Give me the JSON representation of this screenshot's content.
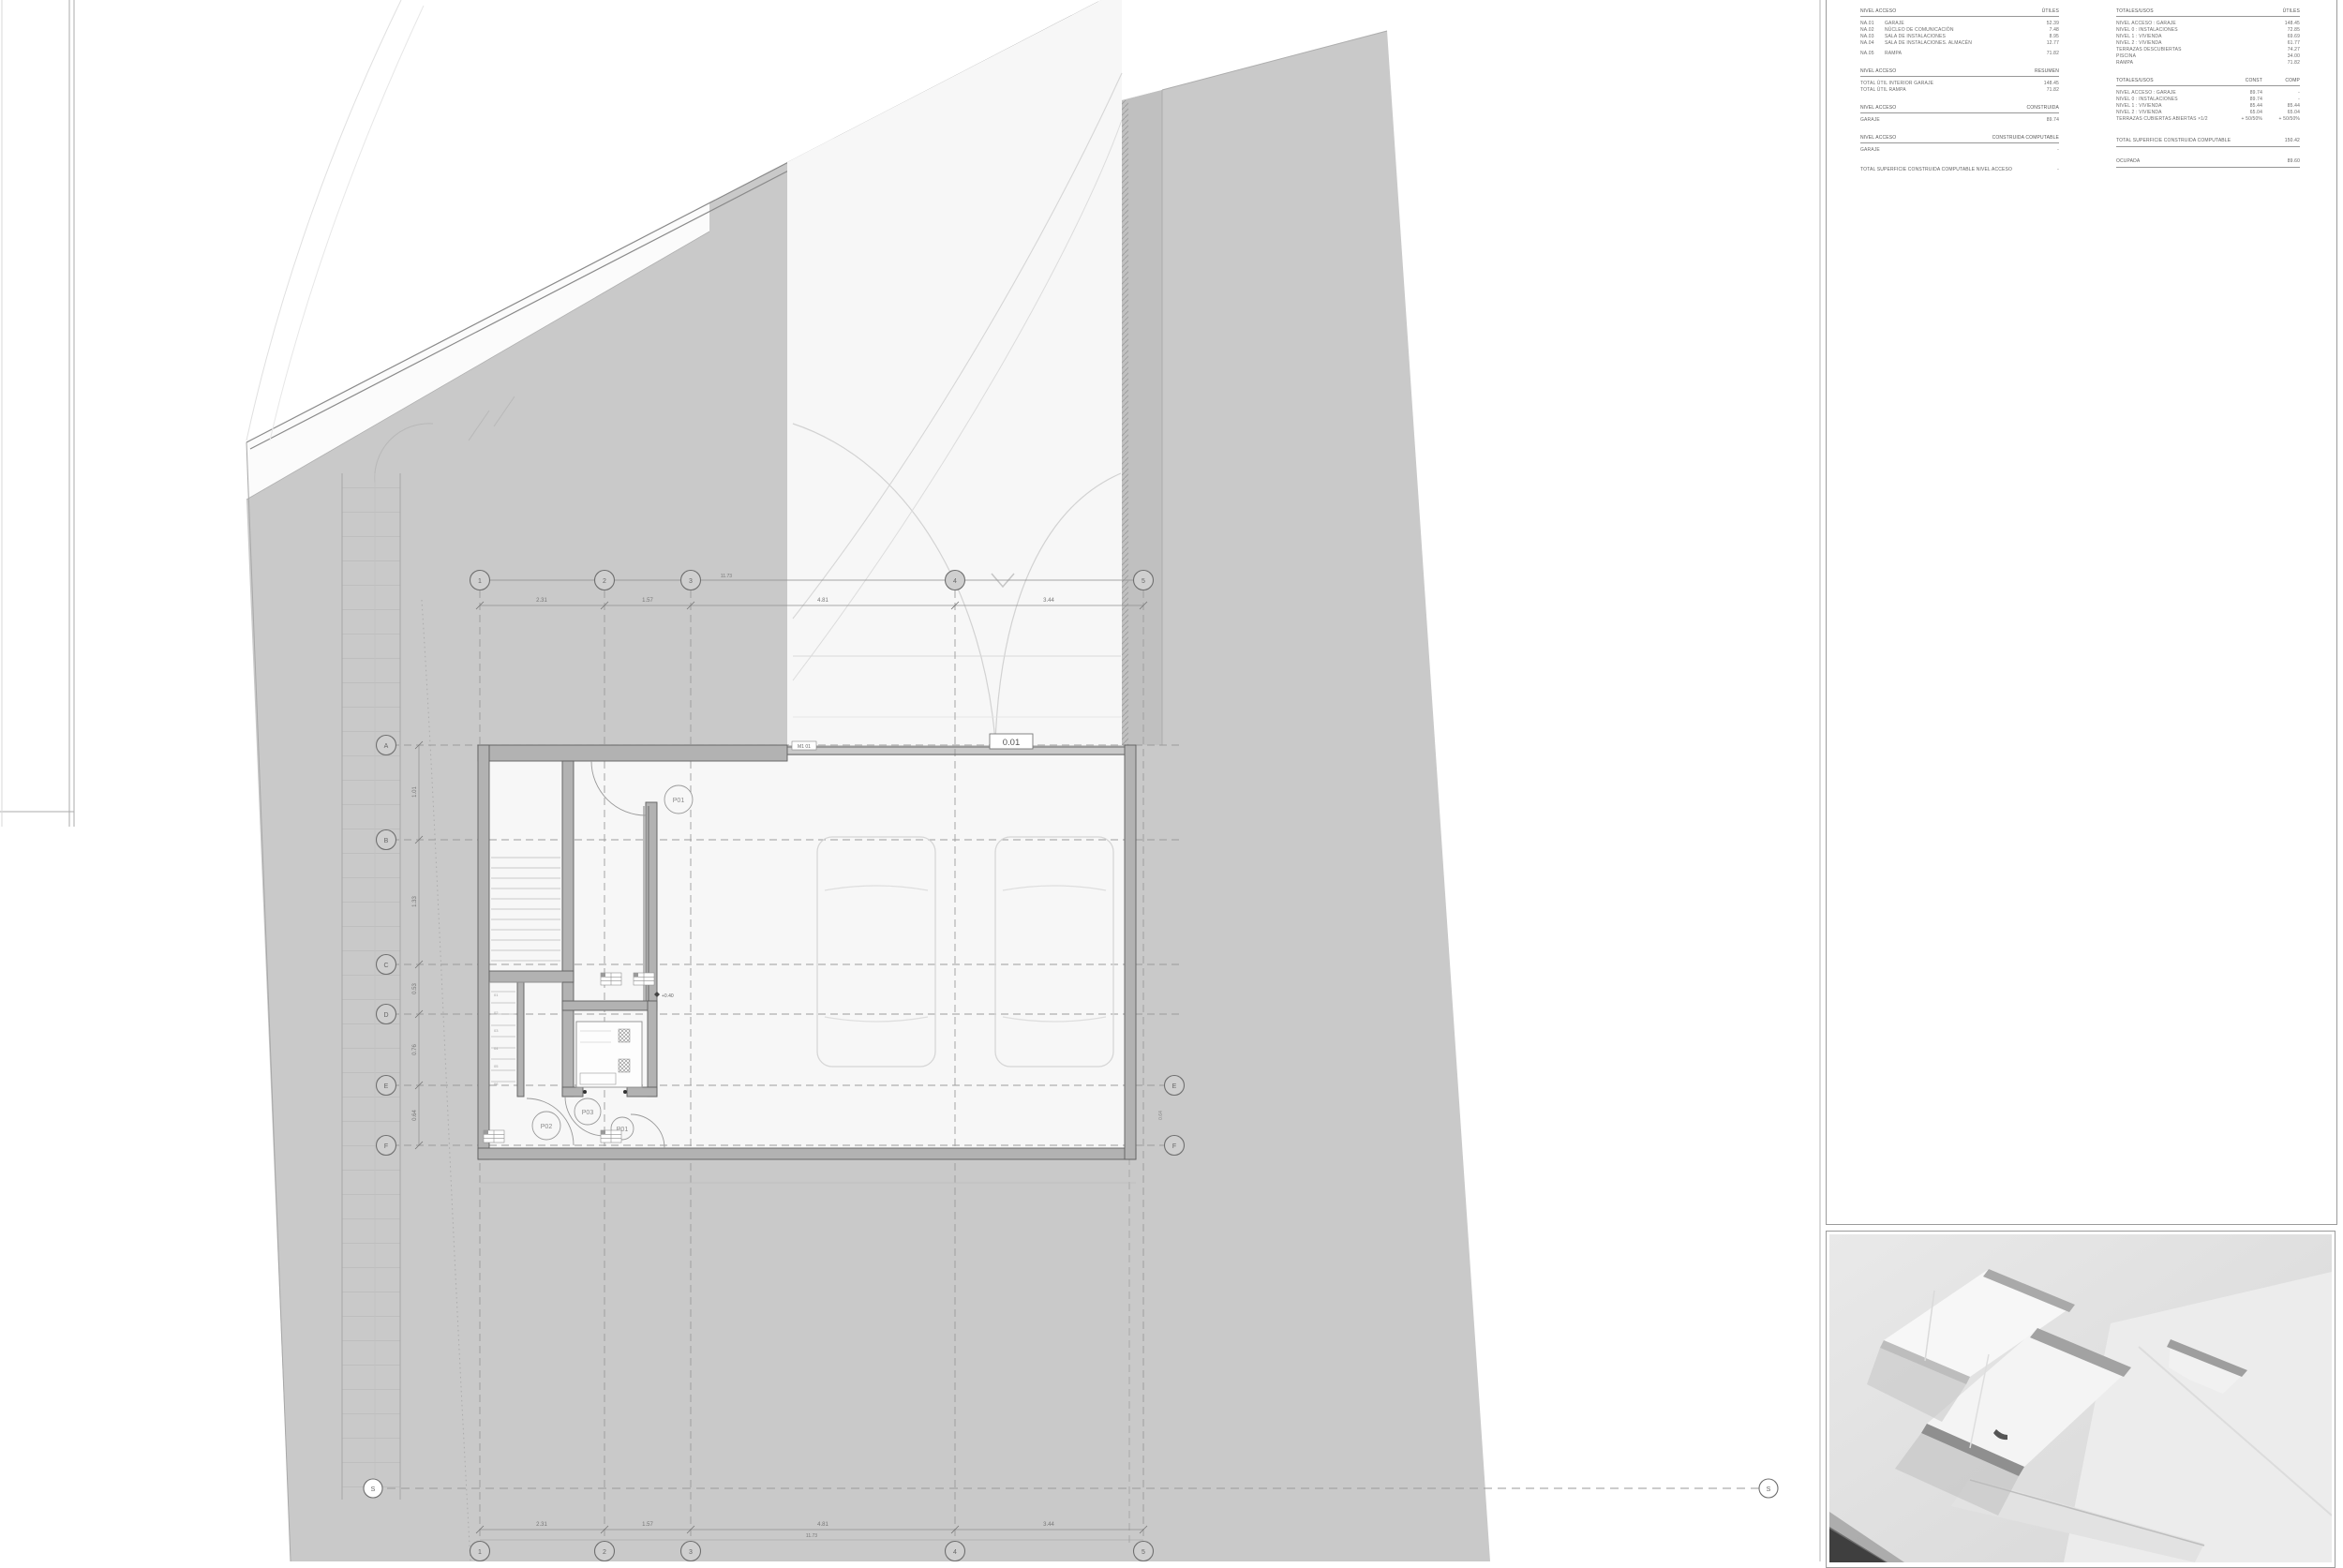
{
  "tables": {
    "access": {
      "s1": {
        "title": "NIVEL ACCESO",
        "col": "ÚTILES",
        "rows": [
          {
            "c": "NA.01",
            "d": "GARAJE",
            "v": "52.39"
          },
          {
            "c": "NA.02",
            "d": "NÚCLEO DE COMUNICACIÓN",
            "v": "7.48"
          },
          {
            "c": "NA.03",
            "d": "SALA DE INSTALACIONES",
            "v": "8.95"
          },
          {
            "c": "NA.04",
            "d": "SALA DE INSTALACIONES. ALMACÉN",
            "v": "12.77"
          },
          {
            "c": "NA.05",
            "d": "RAMPA",
            "v": "71.82"
          }
        ]
      },
      "s2": {
        "title": "NIVEL ACCESO",
        "col": "RESUMEN",
        "rows": [
          {
            "d": "TOTAL ÚTIL INTERIOR GARAJE",
            "v": "148.45"
          },
          {
            "d": "TOTAL ÚTIL RAMPA",
            "v": "71.82"
          }
        ]
      },
      "s3": {
        "title": "NIVEL ACCESO",
        "col": "CONSTRUIDA",
        "rows": [
          {
            "d": "GARAJE",
            "v": "89.74"
          }
        ]
      },
      "s4": {
        "title": "NIVEL ACCESO",
        "col": "CONSTRUIDA COMPUTABLE",
        "rows": [
          {
            "d": "GARAJE",
            "v": "-"
          }
        ]
      },
      "footer": {
        "d": "TOTAL SUPERFICIE CONSTRUIDA COMPUTABLE NIVEL ACCESO",
        "v": "-"
      }
    },
    "totals": {
      "s1": {
        "title": "TOTALES/USOS",
        "col": "ÚTILES",
        "rows": [
          {
            "d": "NIVEL ACCESO : GARAJE",
            "v": "148.45"
          },
          {
            "d": "NIVEL 0 : INSTALACIONES",
            "v": "72.85"
          },
          {
            "d": "NIVEL 1 : VIVIENDA",
            "v": "69.69"
          },
          {
            "d": "NIVEL 2 : VIVIENDA",
            "v": "61.77"
          },
          {
            "d": "TERRAZAS DESCUBIERTAS",
            "v": "74.27"
          },
          {
            "d": "PISCINA",
            "v": "34.00"
          },
          {
            "d": "RAMPA",
            "v": "71.82"
          }
        ]
      },
      "s2": {
        "title": "TOTALES/USOS",
        "col1": "CONST",
        "col2": "COMP",
        "rows": [
          {
            "d": "NIVEL ACCESO : GARAJE",
            "a": "89.74",
            "b": "-"
          },
          {
            "d": "NIVEL 0 : INSTALACIONES",
            "a": "89.74",
            "b": "-"
          },
          {
            "d": "NIVEL 1 : VIVIENDA",
            "a": "85.44",
            "b": "85.44"
          },
          {
            "d": "NIVEL 2 : VIVIENDA",
            "a": "65.04",
            "b": "65.04"
          },
          {
            "d": "TERRAZAS CUBIERTAS ABIERTAS ×1/2",
            "a": "+ 50/50%",
            "b": "+ 50/50%"
          }
        ]
      },
      "total": {
        "d": "TOTAL SUPERFICIE CONSTRUIDA COMPUTABLE",
        "v": "150.42"
      },
      "ocupada": {
        "d": "OCUPADA",
        "v": "89.60"
      }
    }
  },
  "plan": {
    "room_tag": "0.01",
    "threshold_tag": "M1 01",
    "level_marker": "+0.40",
    "grid_cols": [
      "1",
      "2",
      "3",
      "4",
      "5"
    ],
    "grid_rows": [
      "A",
      "B",
      "C",
      "D",
      "E",
      "F"
    ],
    "grid_rows_right": [
      "E",
      "F"
    ],
    "section_marks": [
      "S",
      "S"
    ],
    "door_tags": {
      "p01_top": "P01",
      "p02": "P02",
      "p03": "P03",
      "p01_bottom": "P01"
    },
    "dims_top": [
      "2.31",
      "1.57",
      "4.81",
      "3.44"
    ],
    "dims_bottom": [
      "2.31",
      "1.57",
      "4.81",
      "3.44"
    ],
    "overall_dim": "11.73",
    "dims_left": [
      "1.01",
      "1.33",
      "0.53",
      "0.76",
      "0.64"
    ],
    "dim_right": "0.64",
    "stair_steps": [
      "01",
      "02",
      "03",
      "04",
      "05",
      "06"
    ]
  },
  "colors": {
    "site": "#c9c9c9",
    "interior": "#f7f7f7",
    "wall": "#b2b2b2",
    "wall_line": "#5f5f5f",
    "dash": "#9c9c9c",
    "band": "#c0c0c0",
    "photo_shadow": "#3f3f3f",
    "text": "#6b6b6b"
  }
}
